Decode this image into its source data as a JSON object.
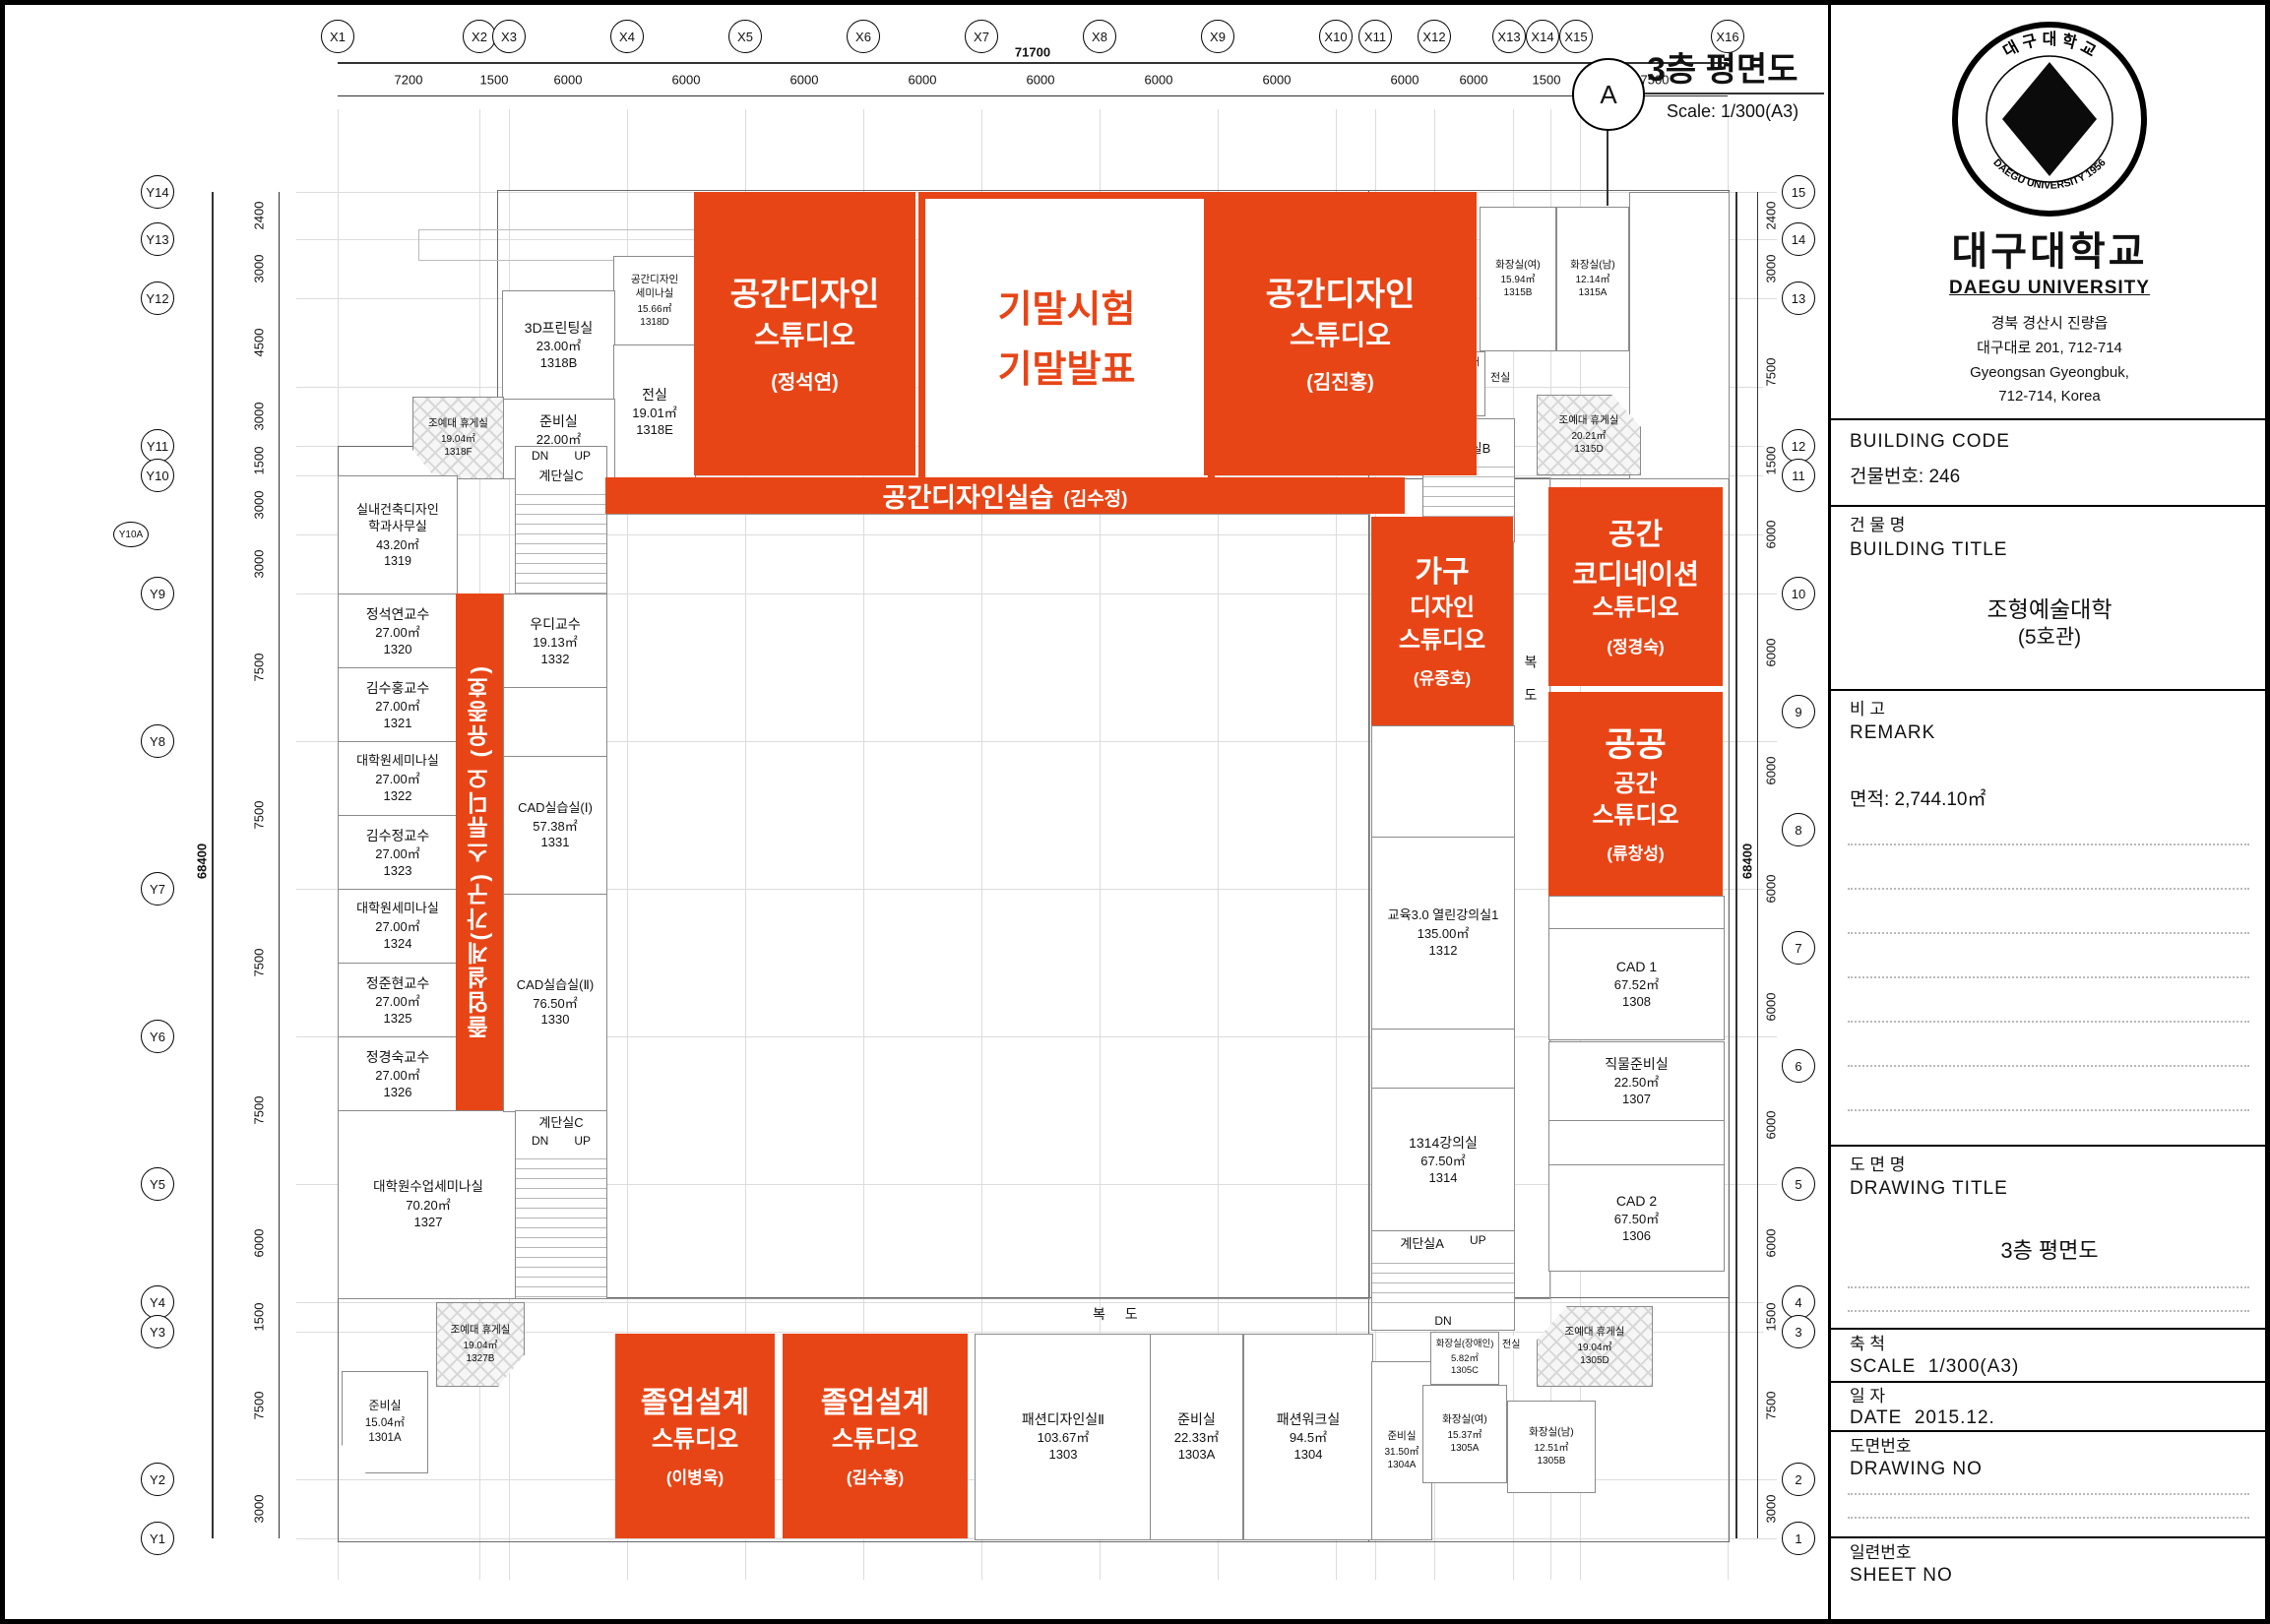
{
  "header": {
    "title": "3층 평면도",
    "scale": "Scale: 1/300(A3)",
    "section_mark": "A"
  },
  "title_block": {
    "logo": {
      "ring_top": "대 구 대 학 교",
      "ring_bottom": "DAEGU UNIVERSITY 1956"
    },
    "university_kr": "대구대학교",
    "university_en": "DAEGU UNIVERSITY",
    "address_lines": [
      "경북 경산시 진량읍",
      "대구대로 201, 712-714",
      "Gyeongsan Gyeongbuk,",
      "712-714, Korea"
    ],
    "building_code_label": "BUILDING CODE",
    "building_code_value": "건물번호: 246",
    "building_title_kr": "건 물 명",
    "building_title_en": "BUILDING TITLE",
    "building_title_value_1": "조형예술대학",
    "building_title_value_2": "(5호관)",
    "remark_kr": "비 고",
    "remark_en": "REMARK",
    "area_value": "면적: 2,744.10㎡",
    "drawing_title_kr": "도 면 명",
    "drawing_title_en": "DRAWING TITLE",
    "drawing_title_value": "3층 평면도",
    "scale_kr": "축 척",
    "scale_label": "SCALE",
    "scale_value": "1/300(A3)",
    "date_kr": "일 자",
    "date_label": "DATE",
    "date_value": "2015.12.",
    "drawing_no_kr": "도면번호",
    "drawing_no_label": "DRAWING NO",
    "sheet_no_kr": "일련번호",
    "sheet_no_label": "SHEET NO"
  },
  "grid": {
    "x_total": "71700",
    "x_labels": [
      "X1",
      "X2",
      "X3",
      "X4",
      "X5",
      "X6",
      "X7",
      "X8",
      "X9",
      "X10",
      "X11",
      "X12",
      "X13",
      "X14",
      "X15",
      "X16"
    ],
    "x_dims": [
      "7200",
      "1500",
      "6000",
      "6000",
      "6000",
      "6000",
      "6000",
      "6000",
      "6000",
      "6000",
      "6000",
      "1500",
      "7500"
    ],
    "y_total_left": "68400",
    "y_total_right": "68400",
    "y_left_labels": [
      "Y14",
      "Y13",
      "Y12",
      "Y11",
      "Y10",
      "Y10A",
      "Y9",
      "Y8",
      "Y7",
      "Y6",
      "Y5",
      "Y4",
      "Y3",
      "Y2",
      "Y1"
    ],
    "y_left_dims": [
      "2400",
      "3000",
      "4500",
      "3000",
      "1500",
      "3000",
      "3000",
      "7500",
      "7500",
      "7500",
      "7500",
      "6000",
      "1500",
      "7500",
      "3000"
    ],
    "y_right_labels": [
      "15",
      "14",
      "13",
      "12",
      "11",
      "10",
      "9",
      "8",
      "7",
      "6",
      "5",
      "4",
      "3",
      "2",
      "1"
    ],
    "y_right_dims": [
      "2400",
      "3000",
      "7500",
      "1500",
      "6000",
      "6000",
      "6000",
      "6000",
      "6000",
      "6000",
      "6000",
      "1500",
      "7500",
      "3000"
    ]
  },
  "exam": {
    "line1": "기말시험",
    "line2": "기말발표"
  },
  "studios": {
    "s1": {
      "l1": "공간디자인",
      "l2": "스튜디오",
      "prof": "(정석연)"
    },
    "s2": {
      "l1": "공간디자인",
      "l2": "스튜디오",
      "prof": "(김진홍)"
    },
    "s3": {
      "label": "공간디자인실습",
      "prof": "(김수정)"
    },
    "s4": {
      "label": "졸업설계(가구) 스튜디오 (유종호)"
    },
    "s5": {
      "l1": "가구",
      "l2": "디자인",
      "l3": "스튜디오",
      "prof": "(유종호)"
    },
    "s6": {
      "l1": "공간",
      "l2": "코디네이션",
      "l3": "스튜디오",
      "prof": "(정경숙)"
    },
    "s7": {
      "l1": "공공",
      "l2": "공간",
      "l3": "스튜디오",
      "prof": "(류창성)"
    },
    "s8": {
      "l1": "졸업설계",
      "l2": "스튜디오",
      "prof": "(이병욱)"
    },
    "s9": {
      "l1": "졸업설계",
      "l2": "스튜디오",
      "prof": "(김수홍)"
    }
  },
  "rooms": {
    "r1318d": {
      "name": "공간디자인\n세미나실",
      "area": "15.66㎡",
      "code": "1318D"
    },
    "r1318b": {
      "name": "3D프린팅실",
      "area": "23.00㎡",
      "code": "1318B"
    },
    "r1318c": {
      "name": "준비실",
      "area": "22.00㎡",
      "code": "1318C"
    },
    "r1318e": {
      "name": "전실",
      "area": "19.01㎡",
      "code": "1318E"
    },
    "r1318f": {
      "name": "조예대 휴게실",
      "area": "19.04㎡",
      "code": "1318F"
    },
    "r1319": {
      "name": "실내건축디자인\n학과사무실",
      "area": "43.20㎡",
      "code": "1319"
    },
    "r1320": {
      "name": "정석연교수",
      "area": "27.00㎡",
      "code": "1320"
    },
    "r1321": {
      "name": "김수홍교수",
      "area": "27.00㎡",
      "code": "1321"
    },
    "r1322": {
      "name": "대학원세미나실",
      "area": "27.00㎡",
      "code": "1322"
    },
    "r1323": {
      "name": "김수정교수",
      "area": "27.00㎡",
      "code": "1323"
    },
    "r1324": {
      "name": "대학원세미나실",
      "area": "27.00㎡",
      "code": "1324"
    },
    "r1325": {
      "name": "정준현교수",
      "area": "27.00㎡",
      "code": "1325"
    },
    "r1326": {
      "name": "정경숙교수",
      "area": "27.00㎡",
      "code": "1326"
    },
    "r1327": {
      "name": "대학원수업세미나실",
      "area": "70.20㎡",
      "code": "1327"
    },
    "r1327b": {
      "name": "조예대 휴게실",
      "area": "19.04㎡",
      "code": "1327B"
    },
    "r1301a": {
      "name": "준비실",
      "area": "15.04㎡",
      "code": "1301A"
    },
    "r1332": {
      "name": "우디교수",
      "area": "19.13㎡",
      "code": "1332"
    },
    "r1331": {
      "name": "CAD실습실(Ⅰ)",
      "area": "57.38㎡",
      "code": "1331"
    },
    "r1330": {
      "name": "CAD실습실(Ⅱ)",
      "area": "76.50㎡",
      "code": "1330"
    },
    "r1312": {
      "name": "교육3.0 열린강의실1",
      "area": "135.00㎡",
      "code": "1312"
    },
    "r1314": {
      "name": "1314강의실",
      "area": "67.50㎡",
      "code": "1314"
    },
    "r1308": {
      "name": "CAD 1",
      "area": "67.52㎡",
      "code": "1308"
    },
    "r1307": {
      "name": "직물준비실",
      "area": "22.50㎡",
      "code": "1307"
    },
    "r1306": {
      "name": "CAD 2",
      "area": "67.50㎡",
      "code": "1306"
    },
    "r1303": {
      "name": "패션디자인실Ⅱ",
      "area": "103.67㎡",
      "code": "1303"
    },
    "r1303a": {
      "name": "준비실",
      "area": "22.33㎡",
      "code": "1303A"
    },
    "r1304": {
      "name": "패션워크실",
      "area": "94.5㎡",
      "code": "1304"
    },
    "r1304a": {
      "name": "준비실",
      "area": "31.50㎡",
      "code": "1304A"
    },
    "r1315a": {
      "name": "화장실(남)",
      "area": "12.14㎡",
      "code": "1315A"
    },
    "r1315b": {
      "name": "화장실(여)",
      "area": "15.94㎡",
      "code": "1315B"
    },
    "r1315c": {
      "name": "화장실(장애인)",
      "area": "5.07㎡",
      "code": "1315C"
    },
    "r1315d": {
      "name": "조예대 휴게실",
      "area": "20.21㎡",
      "code": "1315D"
    },
    "r1305a": {
      "name": "화장실(여)",
      "area": "15.37㎡",
      "code": "1305A"
    },
    "r1305b": {
      "name": "화장실(남)",
      "area": "12.51㎡",
      "code": "1305B"
    },
    "r1305c": {
      "name": "화장실(장애인)",
      "area": "5.82㎡",
      "code": "1305C"
    },
    "r1305d": {
      "name": "조예대 휴게실",
      "area": "19.04㎡",
      "code": "1305D"
    },
    "jeonsil": {
      "name": "전실"
    }
  },
  "stairs": {
    "a": "계단실A",
    "b": "계단실B",
    "c": "계단실C",
    "up": "UP",
    "dn": "DN"
  },
  "corridor": {
    "label": "복 도"
  },
  "colors": {
    "accent": "#e84517"
  }
}
